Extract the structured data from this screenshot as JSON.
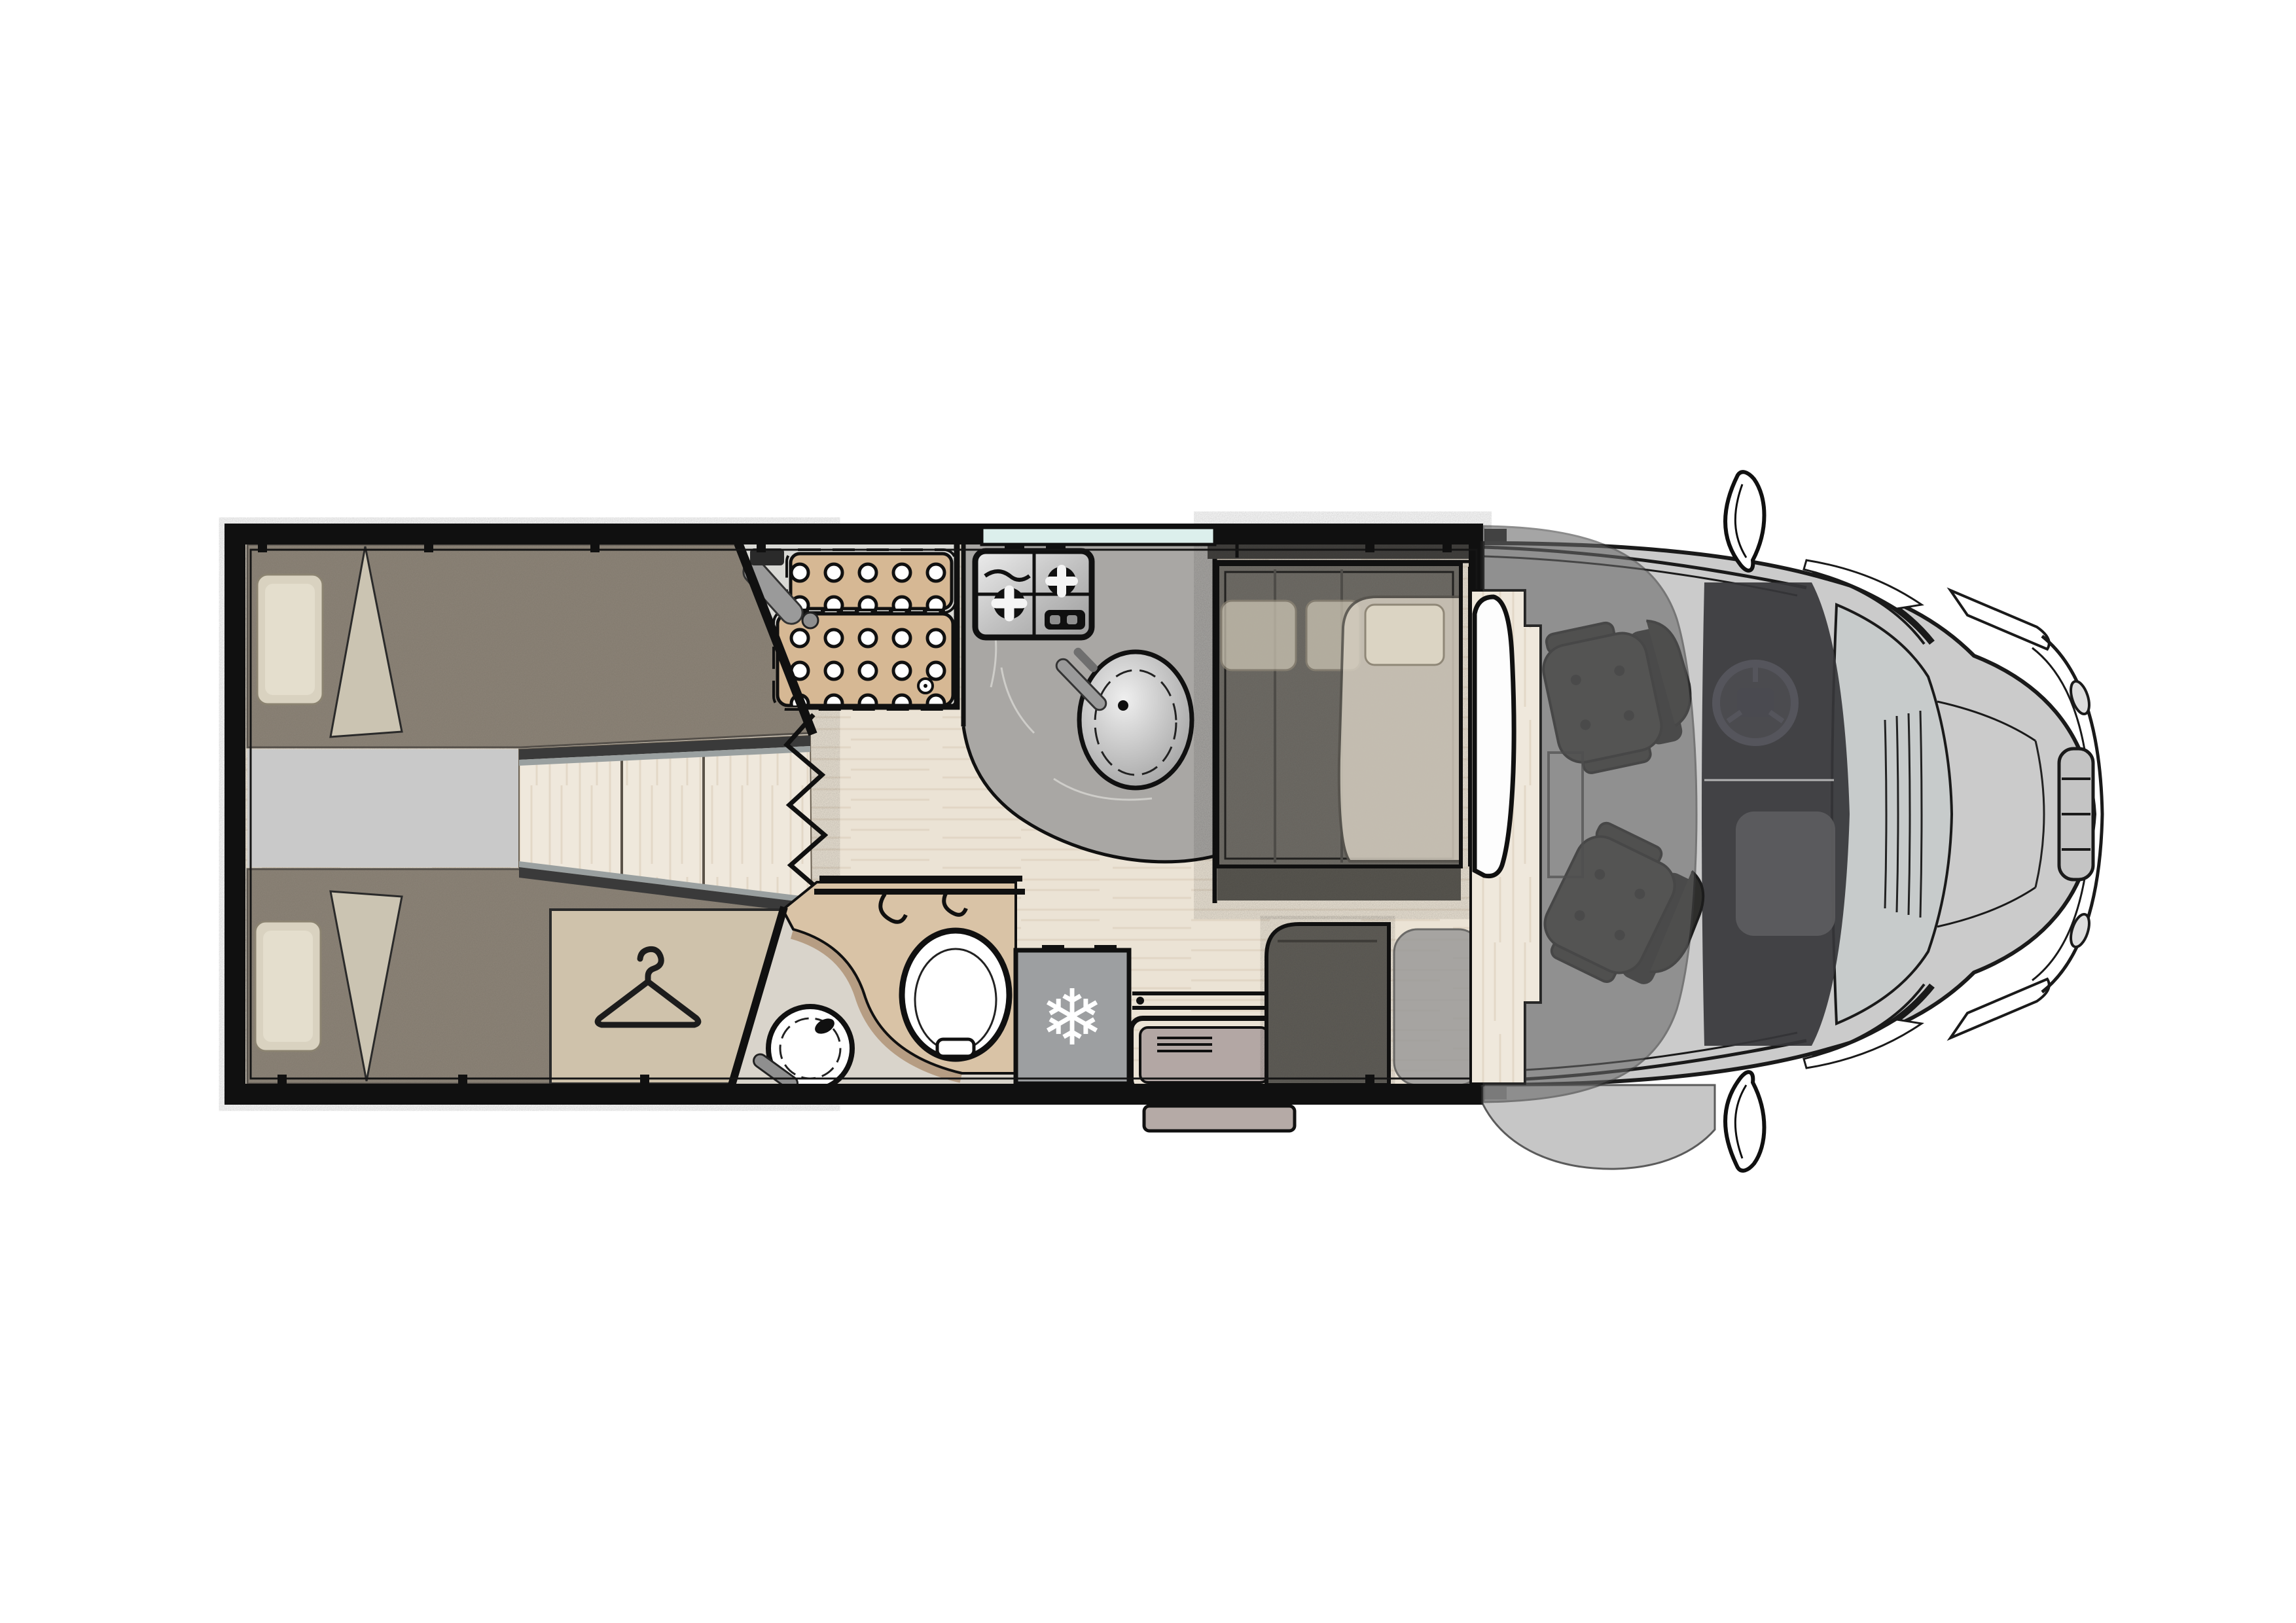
{
  "document": {
    "title": "Motorhome floor plan — top view",
    "type": "vehicle-floorplan",
    "visible_text": "none (drawing only)"
  },
  "palette": {
    "page_bg": "#ffffff",
    "wall": "#101010",
    "line": "#1a1a1a",
    "floor_wood": "#ebe3d5",
    "floor_grain": "#ddd1bf",
    "mattress": "#8d8478",
    "mattress_edge": "#6e675c",
    "pillow": "#d9d2c0",
    "pillow_inner": "#e4decd",
    "blanket": "#cbc4b2",
    "platform": "#c9c9c9",
    "step_wood": "#e7dfd1",
    "step_trim": "#3a3a3a",
    "step_trim2": "#9aa0a0",
    "wardrobe": "#cfc2ab",
    "shower_floor": "#d9d9d5",
    "shower_tray": "#d6b894",
    "slate": "#a9a7a4",
    "slate_vein": "#e8e6e2",
    "window_glass": "#dcefec",
    "wash_counter": "#d9c3a6",
    "wash_shadow": "#b49a7e",
    "marble": "#d9d4cb",
    "fixture_white": "#ffffff",
    "fridge": "#9d9fa1",
    "door_panel": "#b3a7a4",
    "door_step": "#b5aaa6",
    "sideboard": "#413f3c",
    "bench": "#6e6b65",
    "bench_front": "#57554f",
    "side_bench": "#5e5c56",
    "bed_overlay": "#d3ccbe",
    "headrest": "#cfc8b6",
    "bed_pillow": "#ddd6c5",
    "table": "#fdfdfd",
    "wood_platform": "#efe8dc",
    "entry_mat": "#9a9a98",
    "cab_overlay": "#666666",
    "cab_interior": "#37373a",
    "console": "#5d5d5f",
    "seat": "#3c3b39",
    "seat_dark": "#242424",
    "body_gray": "#cbcbcb",
    "windshield": "#c7cbcb",
    "hood": "#cdcdcd",
    "steel_light": "#ededed",
    "steel_dark": "#9c9c9c",
    "mirror_white": "#ffffff"
  },
  "icons": {
    "snowflake": {
      "name": "snowflake-icon",
      "glyph": "❄"
    },
    "hanger": {
      "name": "hanger-icon",
      "glyph": ""
    }
  },
  "floorplan": {
    "vehicle_type": "coachbuilt motorhome, cab at front (right), top view",
    "zones": [
      {
        "id": "rear-bedroom",
        "items": [
          "twin-bed-top",
          "twin-bed-bottom",
          "pillow x2",
          "folded-blanket x2",
          "center-platform",
          "wood-steps",
          "wardrobe (hanger icon)",
          "concertina-door (zigzag)"
        ]
      },
      {
        "id": "shower",
        "items": [
          "duckboard-panel x2 (drain holes)",
          "shower-mixer",
          "drain"
        ]
      },
      {
        "id": "kitchen",
        "items": [
          "window-strip",
          "worktop",
          "two-burner-hob",
          "round-sink with tap"
        ]
      },
      {
        "id": "washroom",
        "items": [
          "vanity-counter",
          "towel-rails",
          "toilet",
          "round-basin with tap"
        ]
      },
      {
        "id": "fridge",
        "items": [
          "refrigerator (snowflake icon)"
        ]
      },
      {
        "id": "entrance",
        "items": [
          "entry-door with rails",
          "outside-step"
        ]
      },
      {
        "id": "lounge",
        "items": [
          "top-sideboard",
          "dinette-bench",
          "headrest x2",
          "drop-down-bed with pillow",
          "side-bench",
          "pedestal-table",
          "wood-floor-platform"
        ]
      },
      {
        "id": "cab",
        "items": [
          "driver-swivel-seat",
          "passenger-swivel-seat",
          "steering-wheel",
          "dashboard-console",
          "overcab-bed-overlay",
          "wing-mirror x2",
          "windshield",
          "hood",
          "headlight x2",
          "grille",
          "front-bumper"
        ]
      }
    ]
  }
}
